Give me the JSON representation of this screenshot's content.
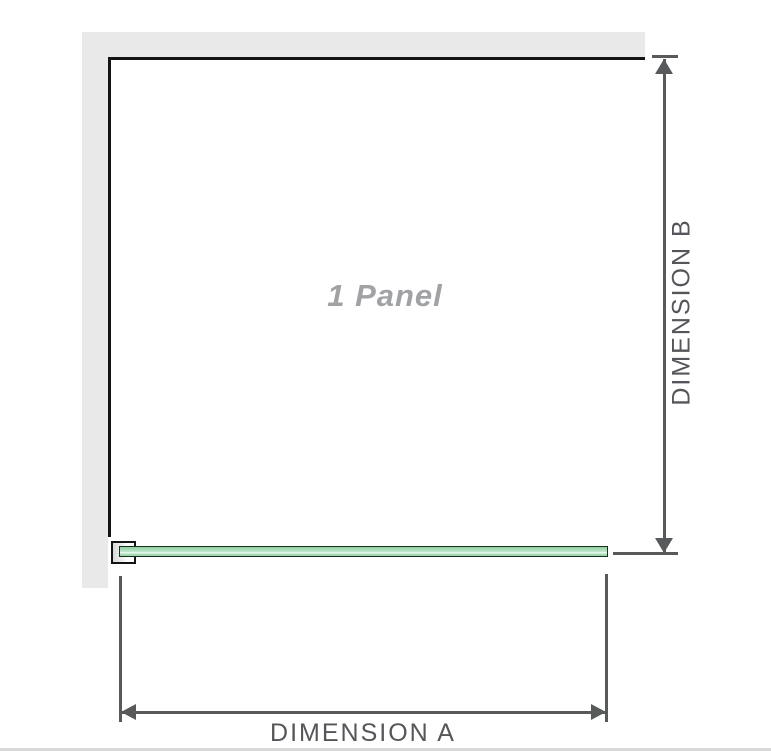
{
  "diagram": {
    "title": "shower screen single panel dimension diagram",
    "panel_label": "1 Panel",
    "dimension_a": {
      "label": "DIMENSION A",
      "orientation": "horizontal"
    },
    "dimension_b": {
      "label": "DIMENSION B",
      "orientation": "vertical"
    },
    "colors": {
      "wall_fill": "#e9e9e9",
      "panel_edge": "#141414",
      "dimension_line": "#58595b",
      "dimension_text": "#55565a",
      "panel_watermark_text": "#a0a2a5",
      "glass_fill": "#a9dcb6",
      "glass_highlight": "#eef9f0",
      "glass_border": "#16301d",
      "bottom_divider": "#d9d9d9"
    }
  }
}
